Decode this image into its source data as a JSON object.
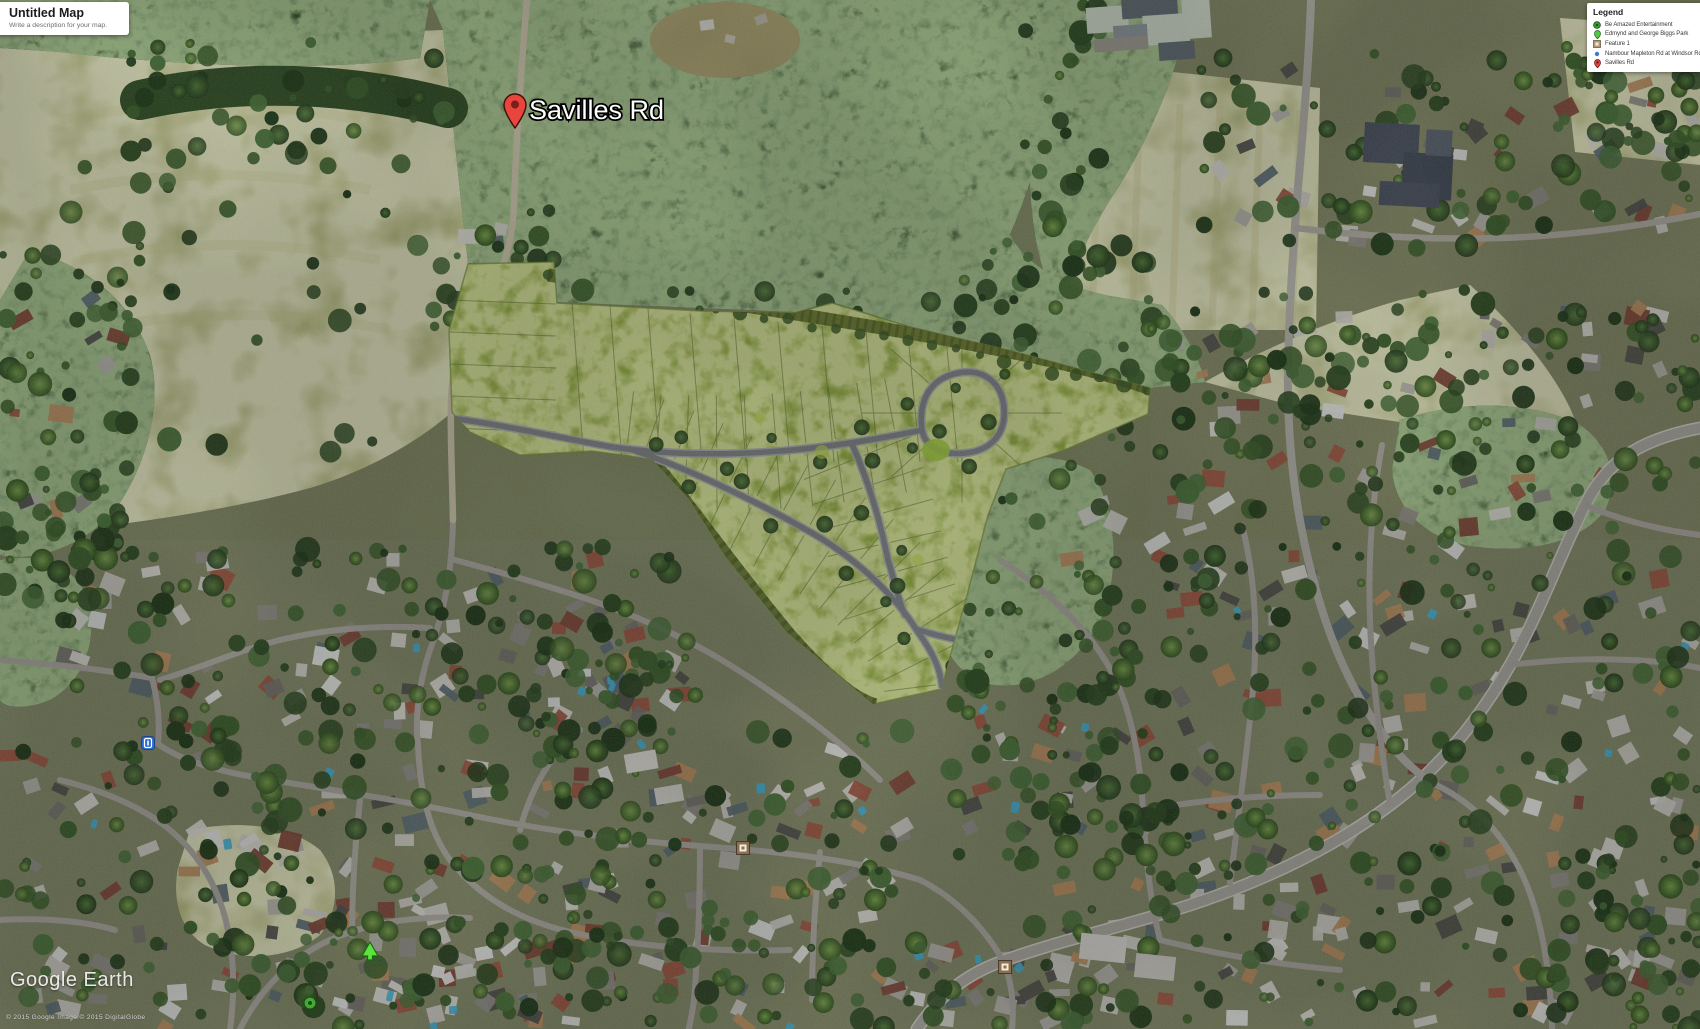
{
  "map_panel": {
    "title": "Untitled Map",
    "description": "Write a description for your map."
  },
  "legend": {
    "title": "Legend",
    "items": [
      {
        "label": "Be Amazed Entertainment",
        "color": "#3d9b36"
      },
      {
        "label": "Edmynd and George Biggs Park",
        "color": "#4fc93f"
      },
      {
        "label": "Feature 1",
        "color": "#b4997d"
      },
      {
        "label": "Nambour Mapleton Rd at Windsor Rd",
        "color": "#3a7bd5"
      },
      {
        "label": "Savilles Rd",
        "color": "#e8453c"
      }
    ]
  },
  "map_labels": {
    "savilles_rd": "Savilles Rd"
  },
  "watermark": {
    "brand": "Google Earth",
    "attribution": "© 2015 Google   Image © 2015 DigitalGlobe"
  },
  "colors": {
    "development_overlay": "#92ab40",
    "pin_red": "#e8453c",
    "marker_blue": "#2a6bd6",
    "marker_tan": "#8a6f52",
    "marker_green_triangle": "#5ce23e",
    "marker_green_circle": "#46a837"
  }
}
